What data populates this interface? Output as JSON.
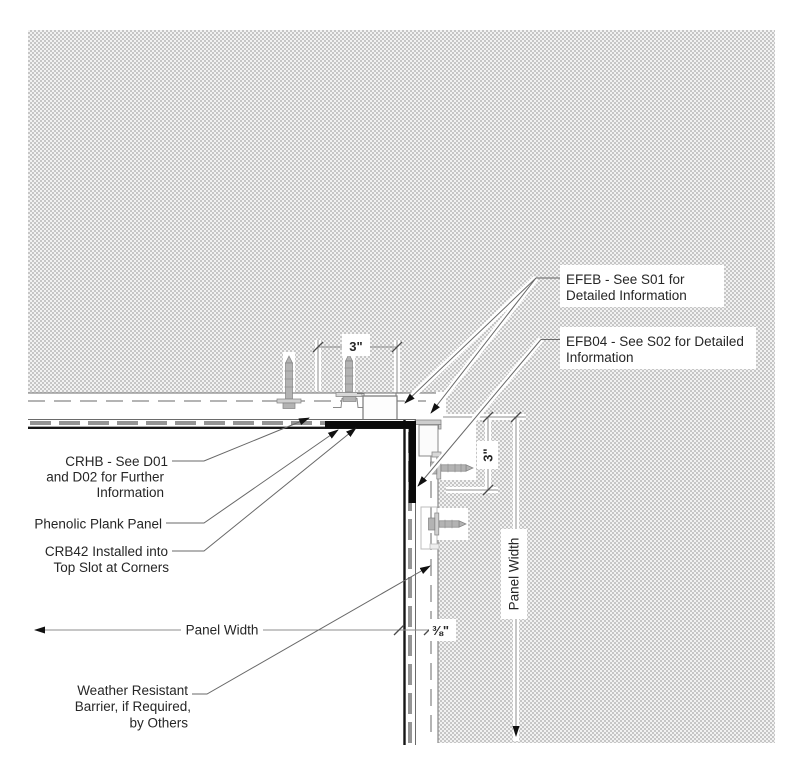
{
  "labels": {
    "efeb": {
      "lines": [
        "EFEB - See S01 for",
        "Detailed Information"
      ]
    },
    "efb04": {
      "lines": [
        "EFB04 - See S02 for Detailed",
        "Information"
      ]
    },
    "crhb": {
      "lines": [
        "CRHB - See D01",
        "and D02 for Further",
        "Information"
      ]
    },
    "phenolic": {
      "lines": [
        "Phenolic Plank Panel"
      ]
    },
    "crb42": {
      "lines": [
        "CRB42 Installed into",
        "Top Slot at Corners"
      ]
    },
    "wrb": {
      "lines": [
        "Weather Resistant",
        "Barrier, if Required,",
        "by Others"
      ]
    },
    "panel_width_horizontal": "Panel Width",
    "panel_width_vertical": "Panel Width"
  },
  "dimensions": {
    "fastener_offset_top": "3\"",
    "fastener_offset_right": "3\"",
    "panel_gap": "⅜\""
  },
  "colors": {
    "stipple_gray": "#c6c6c6",
    "panel_face_black": "#161616",
    "corner_bracket_black": "#0a0a0a",
    "core_dash_gray": "#959595",
    "wrb_dash_gray": "#b4b4b4",
    "dimension_gray": "#8c8c8c",
    "leader_gray": "#686868",
    "text_color": "#262626"
  }
}
